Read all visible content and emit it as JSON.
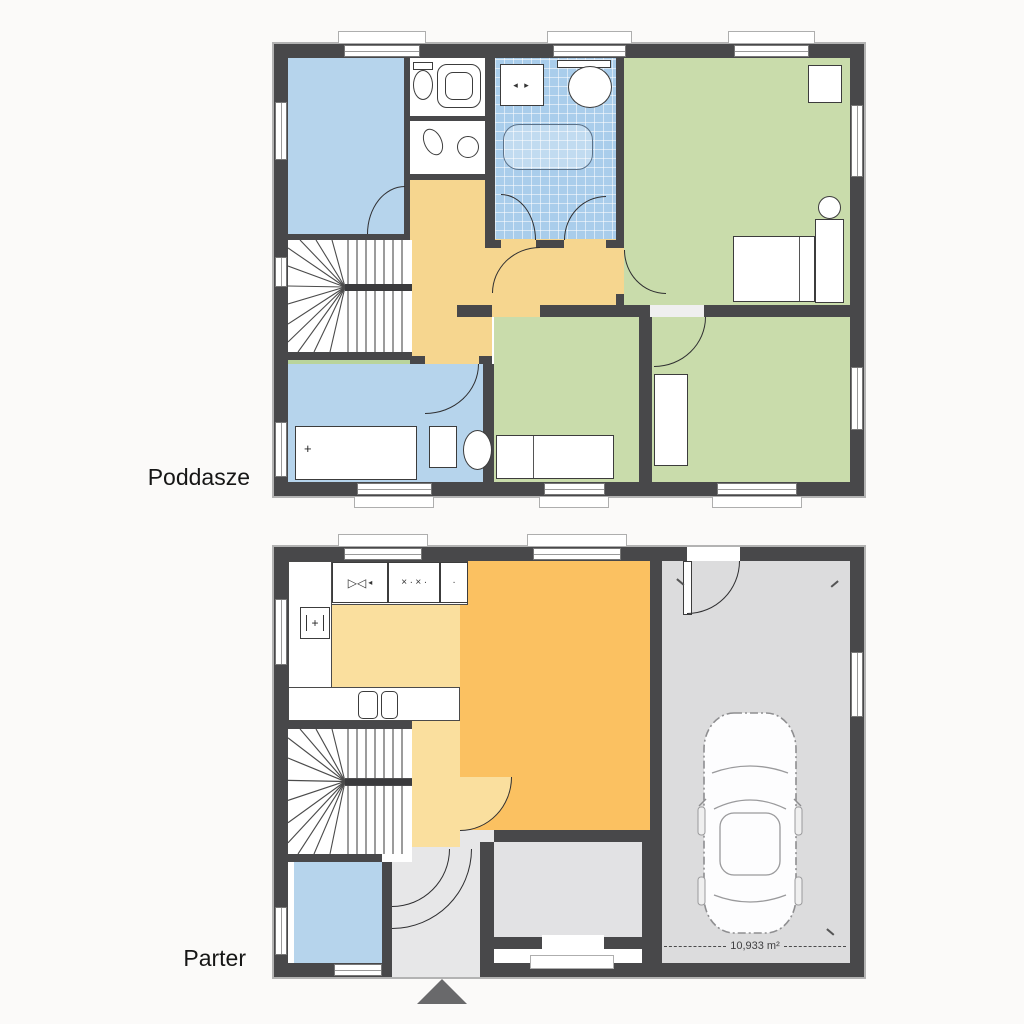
{
  "page": {
    "background": "#fbfaf9"
  },
  "palette": {
    "wall": "#48484a",
    "white": "#ffffff",
    "blue": "#b6d4ec",
    "bath_blue": "#a9cdeb",
    "green": "#c9dcab",
    "green_sliver": "#b9d49b",
    "hall_yellow": "#f6d68f",
    "kitchen_yellow": "#fadf9e",
    "living_orange": "#fbc161",
    "garage_gray": "#dcdcdd",
    "entry_gray": "#e7e7e8",
    "inner_gray": "#e2e2e4"
  },
  "symbols": {
    "fridge_plus": "+",
    "sink_unit": "▷◁",
    "sink_arrow": "◂",
    "stove_marks": "× ∙ × ∙",
    "small_dot": "∙",
    "washer_marks": "◂ ▸",
    "desk_plus": "+"
  },
  "floors": [
    {
      "id": "poddasze",
      "label": "Poddasze",
      "rooms": [
        {
          "name": "bedroom-top-left",
          "fill": "blue"
        },
        {
          "name": "wc",
          "fill": "white",
          "fixtures": [
            "toilet-icon",
            "shower-icon",
            "toilet-icon",
            "washbasin-icon"
          ]
        },
        {
          "name": "bathroom",
          "fill": "bath_blue",
          "fixtures": [
            "washing-machine-icon",
            "shelf-icon",
            "washbasin-icon",
            "bathtub-icon"
          ]
        },
        {
          "name": "bedroom-right",
          "fill": "green",
          "fixtures": [
            "wardrobe-icon",
            "stool-icon",
            "nightstand-icon",
            "bed-icon"
          ]
        },
        {
          "name": "hallway",
          "fill": "hall_yellow"
        },
        {
          "name": "staircase",
          "fill": "white",
          "fixtures": [
            "winder-stairs-icon"
          ]
        },
        {
          "name": "room-bottom-left",
          "fill": "blue",
          "fixtures": [
            "desk-icon",
            "chair-icon",
            "table-icon"
          ]
        },
        {
          "name": "bedroom-bottom-middle",
          "fill": "green",
          "fixtures": [
            "bed-icon"
          ]
        },
        {
          "name": "bedroom-bottom-right",
          "fill": "green",
          "fixtures": [
            "wardrobe-icon"
          ]
        }
      ]
    },
    {
      "id": "parter",
      "label": "Parter",
      "garage_area_label": "10,933 m²",
      "rooms": [
        {
          "name": "kitchen",
          "fill": "kitchen_yellow",
          "fixtures": [
            "sink-icon",
            "stove-icon",
            "fridge-icon",
            "double-sink-icon"
          ]
        },
        {
          "name": "living-room",
          "fill": "living_orange"
        },
        {
          "name": "hall",
          "fill": "kitchen_yellow"
        },
        {
          "name": "staircase",
          "fill": "white",
          "fixtures": [
            "winder-stairs-icon"
          ]
        },
        {
          "name": "wc",
          "fill": "blue"
        },
        {
          "name": "entrance-hall",
          "fill": "entry_gray",
          "fixtures": [
            "door-swing-icon"
          ]
        },
        {
          "name": "inner-hall",
          "fill": "inner_gray"
        },
        {
          "name": "garage",
          "fill": "garage_gray",
          "fixtures": [
            "car-icon",
            "garage-door-icon"
          ]
        }
      ]
    }
  ],
  "markers": {
    "entrance_arrow_icon": "triangle-up"
  }
}
